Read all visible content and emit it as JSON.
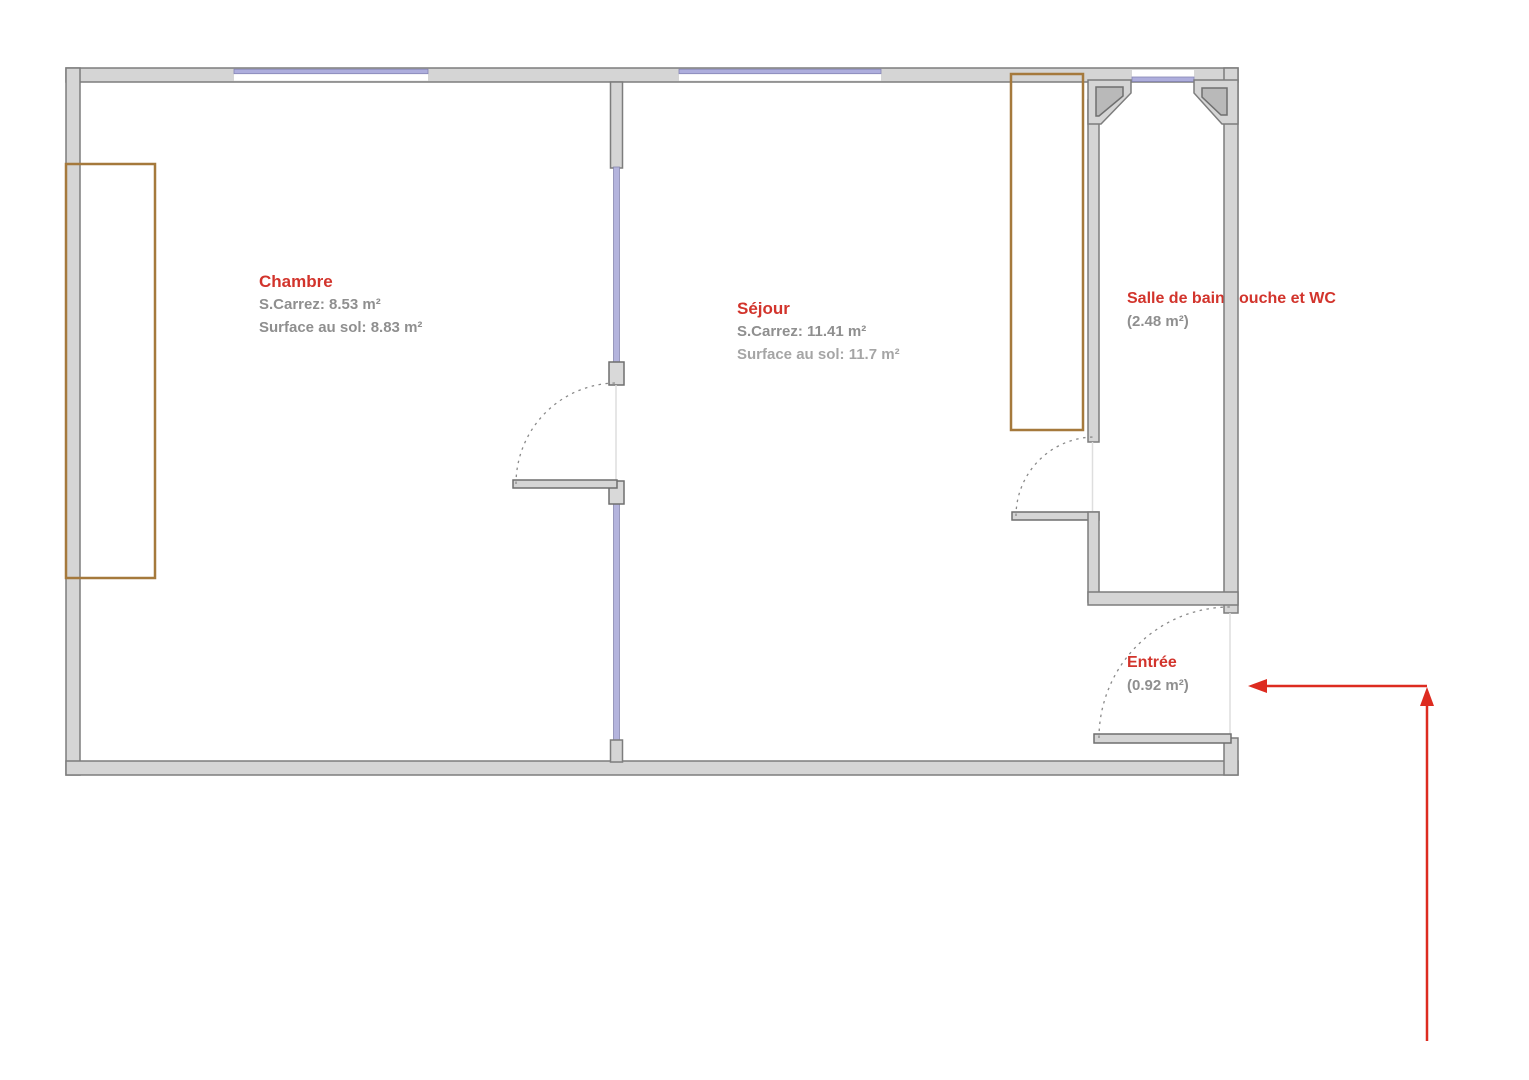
{
  "plan": {
    "title": "Floor plan",
    "rooms": {
      "chambre": {
        "name": "Chambre",
        "carrez": "S.Carrez: 8.53 m²",
        "floor": "Surface au sol: 8.83 m²"
      },
      "sejour": {
        "name": "Séjour",
        "carrez": "S.Carrez: 11.41 m²",
        "floor": "Surface au sol: 11.7 m²"
      },
      "salle_de_bain": {
        "name": "Salle de bain douche et WC",
        "area": "(2.48 m²)"
      },
      "entree": {
        "name": "Entrée",
        "area": "(0.92 m²)"
      }
    },
    "colors": {
      "room_label_red": "#d2342c",
      "area_text_gray": "#8f8f8f",
      "wall_fill": "#d5d5d5",
      "wall_stroke": "#7d7d7d",
      "pier_fill": "#b9b9b9",
      "window_glass": "#aeaedd",
      "furniture_brown": "#a5793c",
      "door_arc_gray": "#8a8a8a",
      "entrance_arrow_red": "#dd2b20"
    }
  }
}
